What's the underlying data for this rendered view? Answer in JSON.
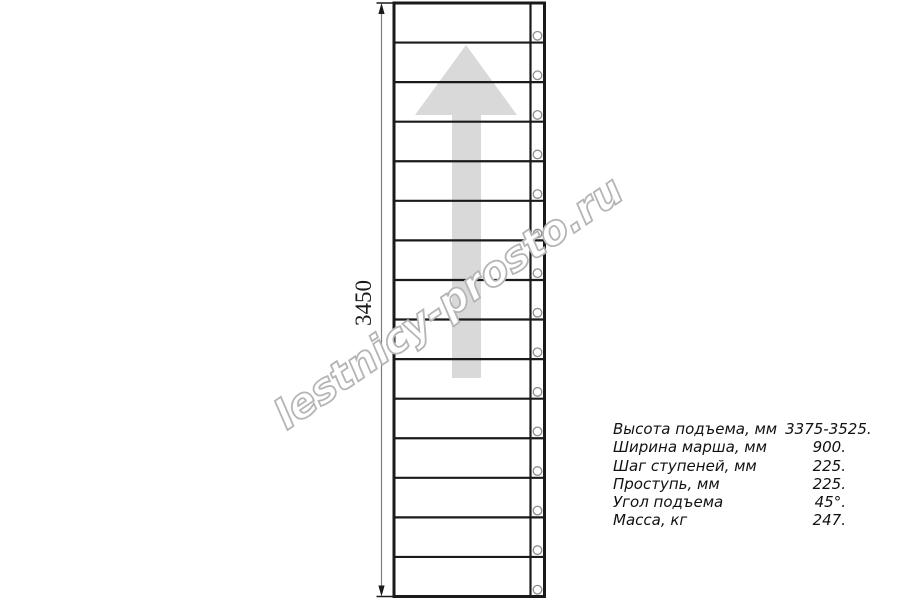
{
  "drawing": {
    "dimension_label": "3450",
    "watermark_text": "lestnicy-prosto.ru",
    "stair": {
      "steps": 15
    },
    "colors": {
      "line": "#1a1a1a",
      "arrow": "#d9d9d9",
      "dimension_line": "#7d7d7d",
      "fastener_stroke": "#8c8c8c",
      "watermark_stroke": "#b5b5b5"
    }
  },
  "specs": {
    "rows": [
      {
        "label": "Высота подъема, мм",
        "value": "3375-3525."
      },
      {
        "label": "Ширина марша, мм",
        "value": "900."
      },
      {
        "label": "Шаг ступеней, мм",
        "value": "225."
      },
      {
        "label": "Проступь, мм",
        "value": "225."
      },
      {
        "label": "Угол подъема",
        "value": "45°."
      },
      {
        "label": "Масса, кг",
        "value": "247."
      }
    ]
  }
}
